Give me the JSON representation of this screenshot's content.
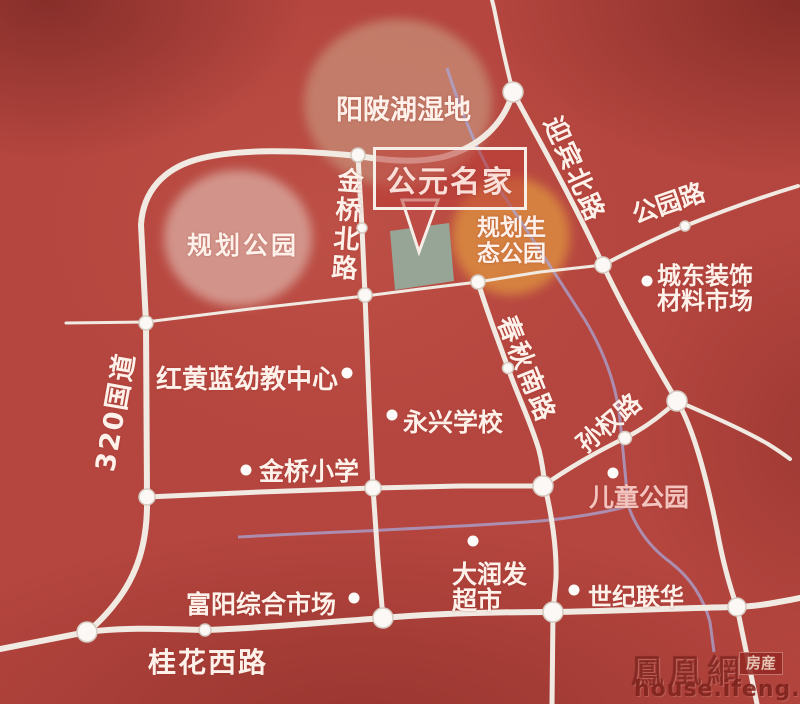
{
  "callout": {
    "label": "公元名家"
  },
  "regions": {
    "wetland": "阳陂湖湿地",
    "planned_park": "规划公园",
    "eco_park_line1": "规划生",
    "eco_park_line2": "态公园"
  },
  "roads": {
    "jinqiao_north": "金桥北路",
    "g320": "320国道",
    "yingbin_north": "迎宾北路",
    "gongyuan": "公园路",
    "chunqiu_south": "春秋南路",
    "sunquan": "孙权路",
    "guihua_west": "桂花西路"
  },
  "landmarks": {
    "chengdong_market_line1": "城东装饰",
    "chengdong_market_line2": "材料市场",
    "kindergarten": "红黄蓝幼教中心",
    "yongxing_school": "永兴学校",
    "jinqiao_primary": "金桥小学",
    "children_park": "儿童公园",
    "darunfa_line1": "大润发",
    "darunfa_line2": "超市",
    "century_lianhua": "世纪联华",
    "fuyang_market": "富阳综合市场"
  },
  "watermark": {
    "brand": "鳳凰網",
    "badge": "房産",
    "url": "house.ifeng.com"
  },
  "colors": {
    "background": "#b5463f",
    "road": "#f1eae2",
    "river": "#a9a6d6",
    "site_square": "#95aa9b",
    "wetland_blob": "#c68973",
    "planned_park_blob": "#d7a197",
    "eco_park_blob": "#d9873f",
    "label_text": "#fdf1ea"
  }
}
